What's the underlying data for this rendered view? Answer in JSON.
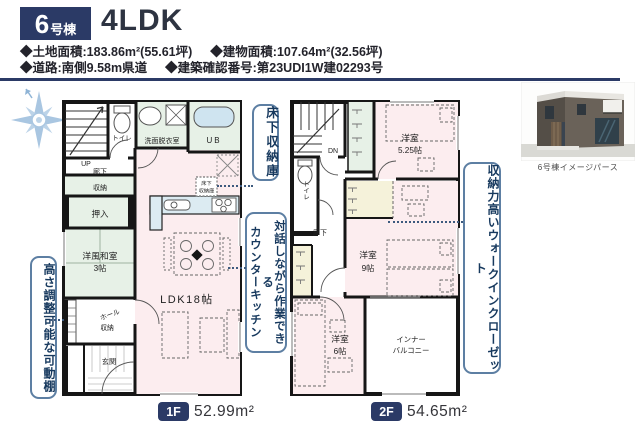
{
  "header": {
    "badge_number": "6",
    "badge_suffix": "号棟",
    "plan_type": "4LDK",
    "specs": {
      "land": "◆土地面積:183.86m²(55.61坪)",
      "building": "◆建物面積:107.64m²(32.56坪)",
      "road": "◆道路:南側9.58m県道",
      "confirmation": "◆建築確認番号:第23UDI1W建02293号"
    }
  },
  "perspective_caption": "6号棟イメージパース",
  "callouts": {
    "underfloor_storage": "床下収納庫",
    "counter_kitchen_line1": "対話しながら作業できる",
    "counter_kitchen_line2": "カウンターキッチン",
    "adjustable_shelf": "高さ調整可能な可動棚",
    "walk_in_closet": "収納力高いウォークインクローゼット"
  },
  "floor1": {
    "badge": "1F",
    "area": "52.99m²",
    "labels": {
      "up": "UP",
      "toilet": "トイレ",
      "washroom": "洗面脱衣室",
      "bath": "UB",
      "hallway": "廊下",
      "storage": "収納",
      "closet": "押入",
      "japanese_room": "洋風和室",
      "japanese_room_size": "3帖",
      "hall": "ホール",
      "hall_storage": "収納",
      "entrance": "玄関",
      "ldk": "LDK18帖",
      "underfloor_l1": "床下",
      "underfloor_l2": "収納庫"
    }
  },
  "floor2": {
    "badge": "2F",
    "area": "54.65m²",
    "labels": {
      "down": "DN",
      "toilet": "トイレ",
      "hallway": "廊下",
      "room525": "洋室",
      "room525_size": "5.25帖",
      "room9": "洋室",
      "room9_size": "9帖",
      "room6": "洋室",
      "room6_size": "6帖",
      "balcony_l1": "インナー",
      "balcony_l2": "バルコニー"
    }
  },
  "colors": {
    "navy": "#2b3a66",
    "room_green": "#e7f1e7",
    "room_pink": "#fcedef",
    "room_yellow": "#f5f2da",
    "counter_blue": "#dcebf2",
    "callout_border": "#5d7fa3"
  }
}
